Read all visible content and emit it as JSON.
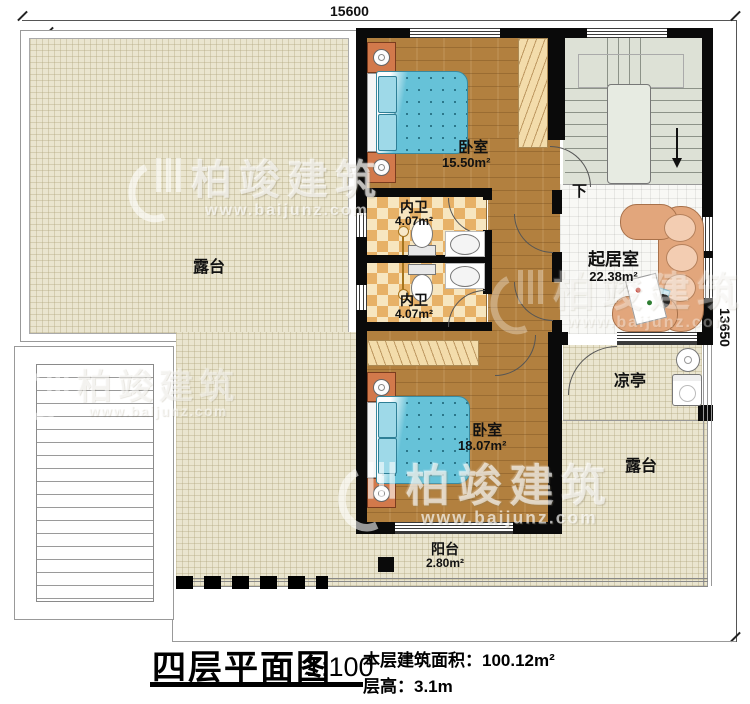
{
  "plan": {
    "dims": {
      "top": "15600",
      "right": "13650"
    },
    "rooms": {
      "terrace_left": {
        "name": "露台"
      },
      "bedroom_top": {
        "name": "卧室",
        "area": "15.50m²"
      },
      "bath_top": {
        "name": "内卫",
        "area": "4.07m²"
      },
      "bath_bottom": {
        "name": "内卫",
        "area": "4.07m²"
      },
      "bedroom_bottom": {
        "name": "卧室",
        "area": "18.07m²"
      },
      "living": {
        "name": "起居室",
        "area": "22.38m²"
      },
      "pavilion": {
        "name": "凉亭"
      },
      "terrace_right": {
        "name": "露台"
      },
      "balcony": {
        "name": "阳台",
        "area": "2.80m²"
      },
      "stairs": {
        "down_label": "下"
      }
    },
    "title_block": {
      "title": "四层平面图",
      "scale": "1:100",
      "area_label": "本层建筑面积：",
      "area_value": "100.12m²",
      "height_label": "层高：",
      "height_value": "3.1m"
    },
    "watermark": {
      "brand": "柏竣建筑",
      "url": "www.baijunz.com"
    },
    "colors": {
      "wall": "#0a0a0a",
      "wood_floor": "#b2803f",
      "terrace_floor": "#eae5cf",
      "tile_floor": "#f8f8f5",
      "bath_tile_dark": "#e7b167",
      "bath_tile_light": "#f7e6c0",
      "stair_floor": "#dde1d6",
      "bed_blue": "#66c2d8",
      "nightstand_orange": "#d2794b",
      "sofa_tan": "#e2a67c"
    }
  }
}
